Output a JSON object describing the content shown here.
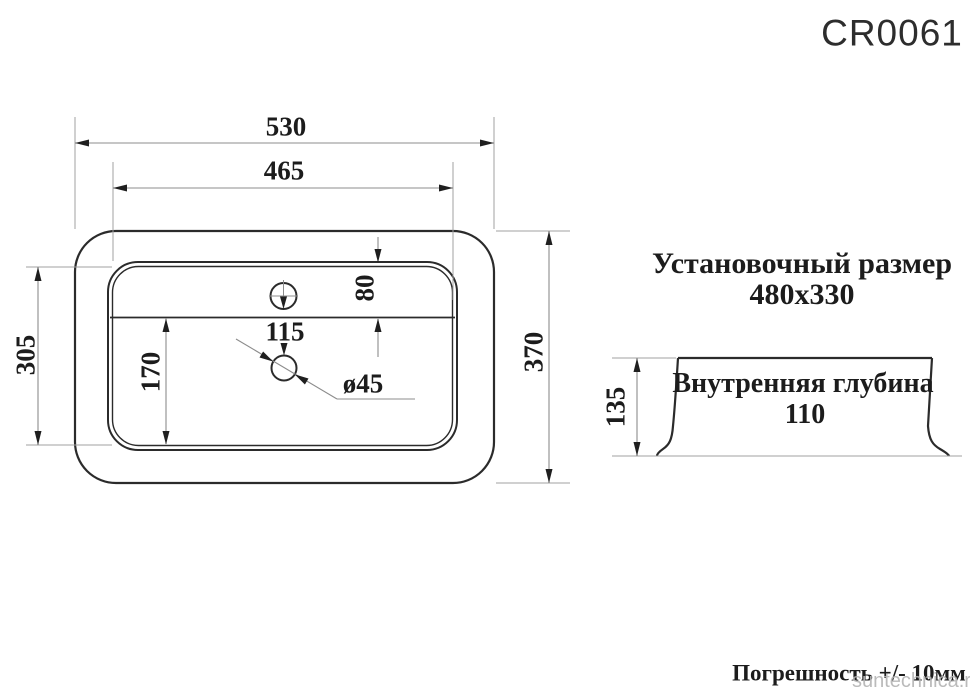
{
  "title": "CR0061",
  "top_view": {
    "dim_overall_width": "530",
    "dim_inner_width": "465",
    "dim_inner_height": "305",
    "dim_overall_height": "370",
    "dim_faucet_offset": "80",
    "dim_hole_spacing": "115",
    "dim_drain_offset": "170",
    "dim_drain_diameter": "ø45"
  },
  "side_view": {
    "dim_height": "135",
    "inner_depth_label": "Внутренняя глубина",
    "inner_depth_value": "110"
  },
  "install": {
    "label": "Установочный размер",
    "value": "480x330"
  },
  "footer": {
    "tolerance": "Погрешность +/- 10мм",
    "watermark": "suntechnica.ru"
  },
  "colors": {
    "line_dark": "#2b2b2b",
    "line_light": "#909090",
    "text": "#1c1c1c",
    "watermark": "#b4b4b4"
  }
}
